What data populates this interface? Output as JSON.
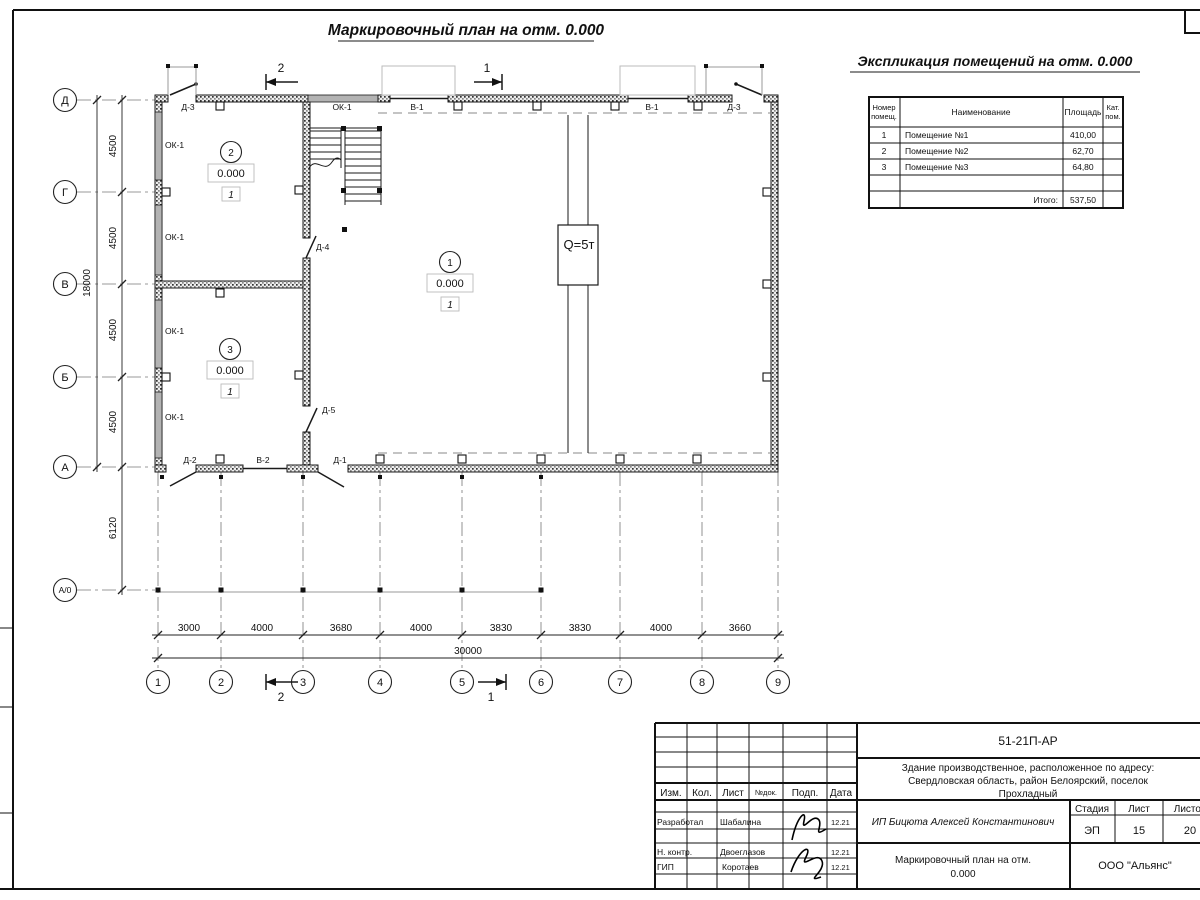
{
  "plan_title": "Маркировочный план на отм. 0.000",
  "explication": {
    "title": "Экспликация помещений на отм. 0.000",
    "headers": {
      "num1": "Номер",
      "num2": "помещ.",
      "name": "Наименование",
      "area": "Площадь",
      "cat1": "Кат.",
      "cat2": "пом."
    },
    "rows": [
      [
        "1",
        "Помещение №1",
        "410,00"
      ],
      [
        "2",
        "Помещение №2",
        "62,70"
      ],
      [
        "3",
        "Помещение №3",
        "64,80"
      ]
    ],
    "total_label": "Итого:",
    "total_value": "537,50"
  },
  "axes": {
    "rows": [
      "Д",
      "Г",
      "В",
      "Б",
      "А",
      "А/0"
    ],
    "cols": [
      "1",
      "2",
      "3",
      "4",
      "5",
      "6",
      "7",
      "8",
      "9"
    ]
  },
  "dims": {
    "h": [
      "3000",
      "4000",
      "3680",
      "4000",
      "3830",
      "3830",
      "4000",
      "3660"
    ],
    "h_total": "30000",
    "v": [
      "4500",
      "4500",
      "4500",
      "4500"
    ],
    "v_total": "18000",
    "v_offset": "6120"
  },
  "plan": {
    "labels": {
      "ok1": "ОК-1",
      "v1": "В-1",
      "v2": "В-2",
      "d1": "Д-1",
      "d2": "Д-2",
      "d3": "Д-3",
      "d4": "Д-4",
      "d5": "Д-5"
    },
    "crane": "Q=5т",
    "level": "0.000",
    "category": "1",
    "rooms": [
      "1",
      "2",
      "3"
    ],
    "sections": {
      "s1": "1",
      "s2": "2"
    }
  },
  "titleblock": {
    "doc_number": "51-21П-АР",
    "address_line1": "Здание производственное, расположенное по адресу:",
    "address_line2": "Свердловская область, район Белоярский, поселок",
    "address_line3": "Прохладный",
    "client": "ИП Бицюта Алексей Константинович",
    "sheet_title_line1": "Маркировочный план на отм.",
    "sheet_title_line2": "0.000",
    "company": "ООО \"Альянс\"",
    "cols": {
      "izm": "Изм.",
      "kol": "Кол.",
      "list": "Лист",
      "doc": "№док.",
      "podp": "Подп.",
      "data": "Дата"
    },
    "stage": {
      "label_stage": "Стадия",
      "label_sheet": "Лист",
      "label_sheets": "Листов",
      "stage": "ЭП",
      "sheet": "15",
      "sheets": "20"
    },
    "roles": [
      {
        "role": "Разработал",
        "name": "Шабалина",
        "date": "12.21"
      },
      {
        "role": "Н. контр.",
        "name": "Двоеглазов",
        "date": "12.21"
      },
      {
        "role": "ГИП",
        "name": "Коротаев",
        "date": "12.21"
      }
    ]
  }
}
